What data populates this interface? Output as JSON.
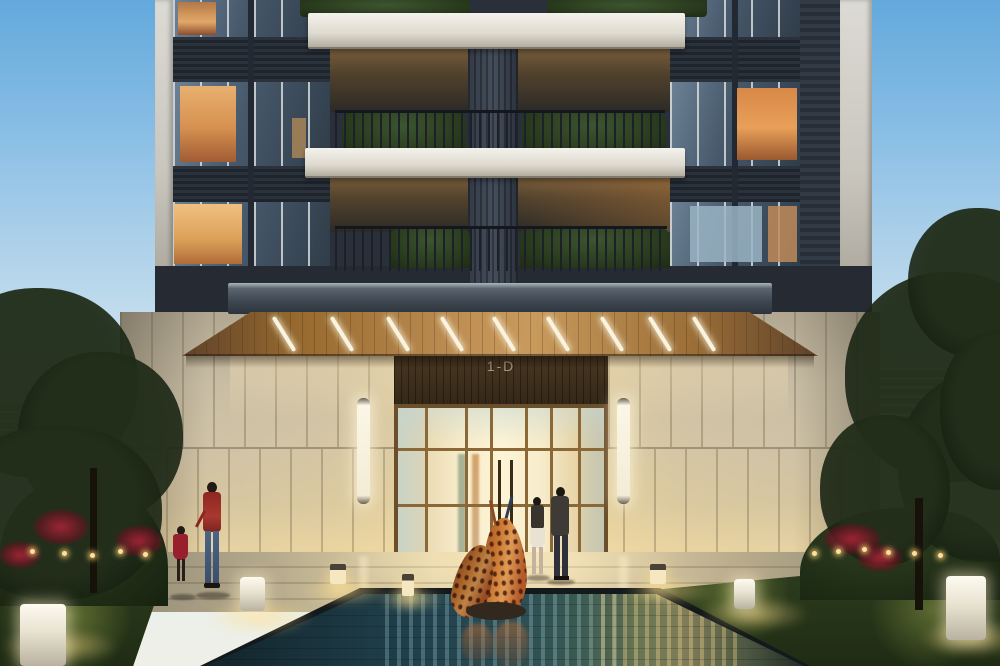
{
  "scene": {
    "description": "dusk architectural rendering of a residential tower entrance with reflecting pool",
    "sign": {
      "label": "1-D"
    },
    "palette": {
      "sky_top": "#63a9dc",
      "sky_horizon": "#eef0e8",
      "tower_facade": "#3a4250",
      "balcony_slab": "#f2f0ea",
      "balcony_hedge": "#31452a",
      "canopy_wood": "#c09055",
      "canopy_light": "#faf3df",
      "podium_wall": "#cfc2a6",
      "entrance_glass_glow": "#f9f1d4",
      "entrance_frame_bronze": "#6b4f2a",
      "sconce_light": "#f8f2e0",
      "pool_water_dark": "#1b3640",
      "pool_reflection_warm": "#8a8560",
      "sculpture_copper": "#c9762f",
      "lawn": "#2c3c1d",
      "flower_red": "#a42838",
      "bollard_light": "#fdfaf0"
    },
    "elements": {
      "building": "high-rise tower with planted balconies",
      "canopy": "wood-soffit entry canopy with angled LED strips",
      "entrance": "bronze-framed glass lobby doors",
      "water_feature": "reflecting pool with copper crane sculpture",
      "figures": [
        "woman walking with child",
        "couple walking toward entrance"
      ]
    }
  }
}
